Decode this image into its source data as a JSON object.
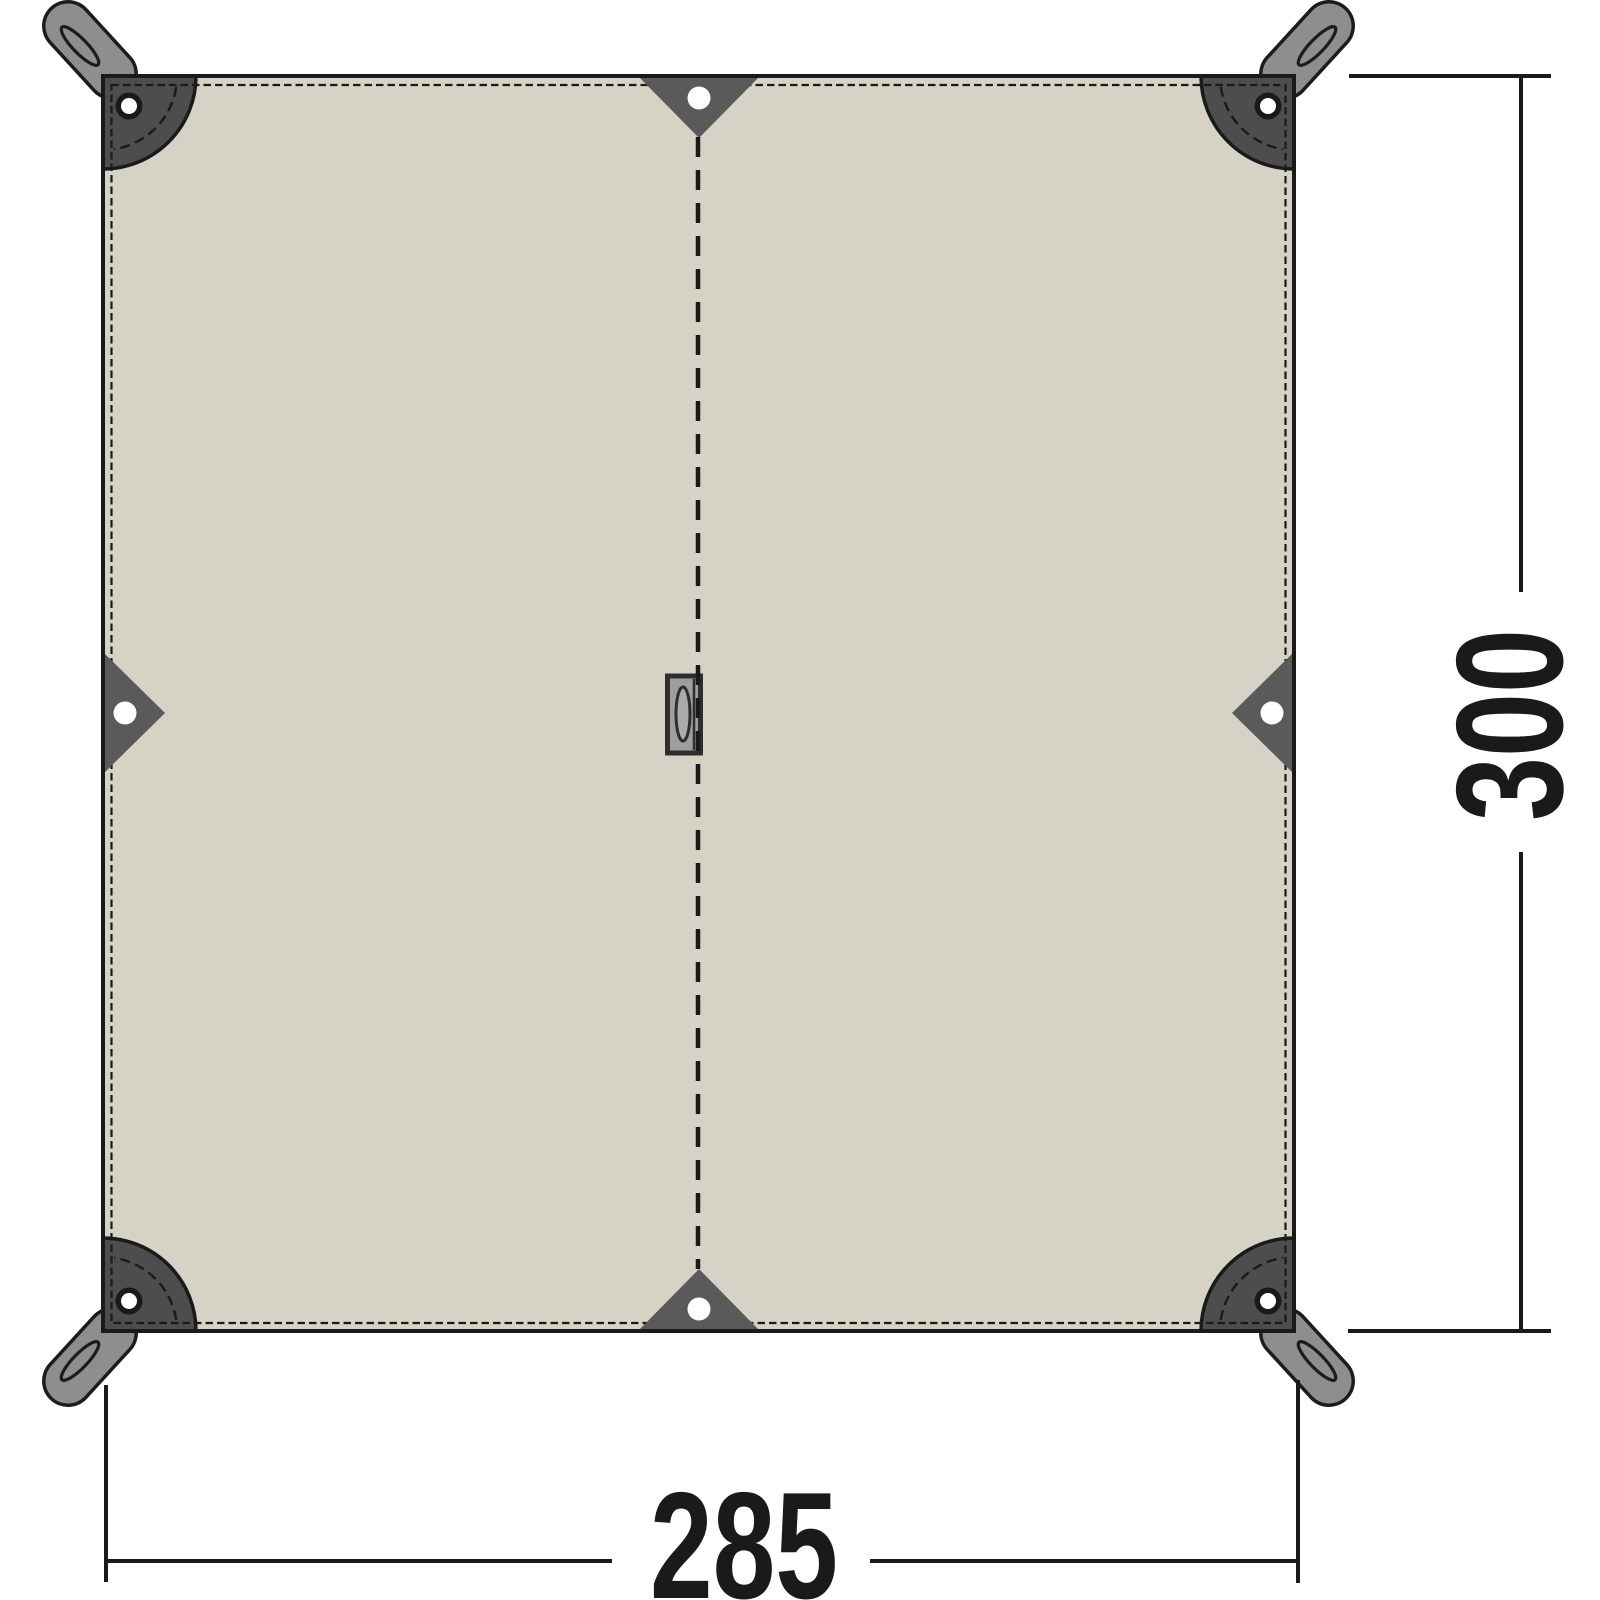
{
  "diagram": {
    "figure_type": "tarp top-view dimension drawing",
    "height_label": "300",
    "width_label": "285",
    "colors": {
      "background": "#ffffff",
      "fabric": "#d6d2c6",
      "corner_patch": "#4d4d4d",
      "edge_triangle": "#5a5a5a",
      "strap": "#8e8e8e",
      "buckle": "#9e9e9e",
      "grommet": "#ffffff",
      "line": "#1a1a1a"
    }
  }
}
